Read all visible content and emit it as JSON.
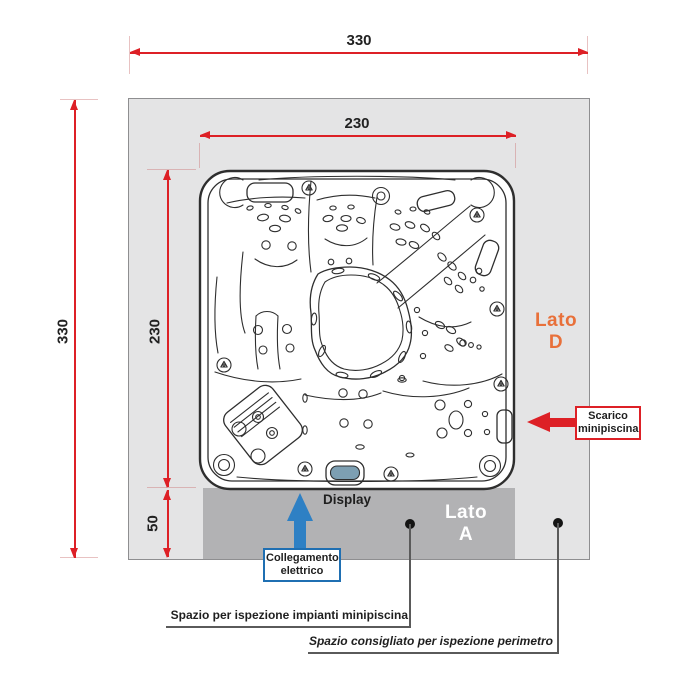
{
  "colors": {
    "surface": "#e4e4e5",
    "surface_border": "#8e8e90",
    "strip": "#b2b2b4",
    "dim_red": "#dd2026",
    "accent_orange": "#e8703a",
    "accent_blue": "#2e80c4",
    "blue_border": "#1f6fb2",
    "display_fill": "#7d9fb2",
    "line_art": "#2e2e2e",
    "text_dark": "#1f1f1f",
    "leader_gray": "#5a5a5a"
  },
  "dimensions": {
    "overall_width": "330",
    "overall_height": "330",
    "tub_width": "230",
    "tub_height": "230",
    "service_depth": "50"
  },
  "sides": {
    "d": {
      "word": "Lato",
      "letter": "D"
    },
    "a": {
      "word": "Lato",
      "letter": "A"
    }
  },
  "callouts": {
    "display": "Display",
    "drain": {
      "line1": "Scarico",
      "line2": "minipiscina"
    },
    "electrical": {
      "line1": "Collegamento",
      "line2": "elettrico"
    },
    "inspection_note": "Spazio per ispezione impianti minipiscina",
    "perimeter_note": "Spazio consigliato per ispezione perimetro"
  },
  "icons": {
    "drain_arrow": "left-arrow",
    "electrical_arrow": "up-arrow",
    "leader_marker": "dot"
  }
}
